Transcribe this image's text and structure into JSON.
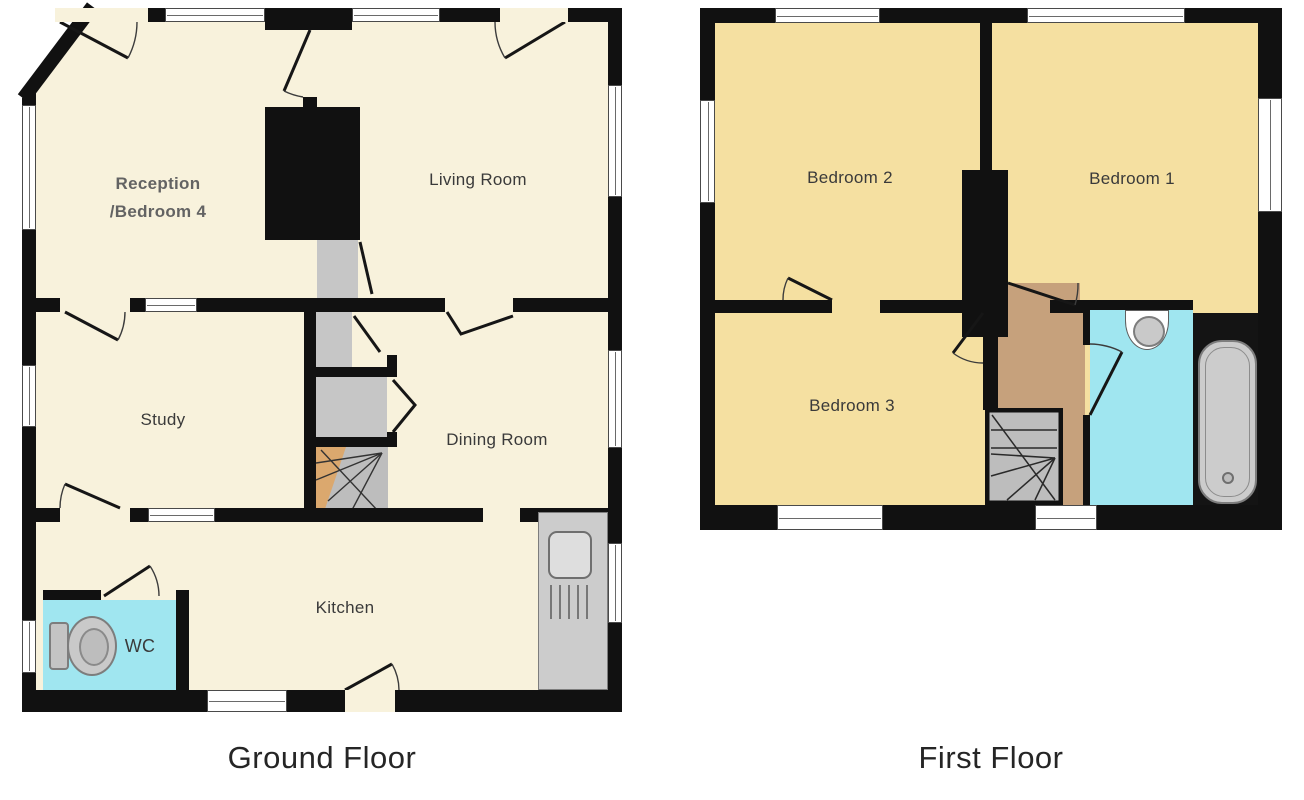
{
  "document_type": "property-floor-plan",
  "ground_floor": {
    "title": "Ground Floor",
    "rooms": {
      "reception_line1": "Reception",
      "reception_line2": "/Bedroom 4",
      "living_room": "Living Room",
      "study": "Study",
      "dining_room": "Dining Room",
      "kitchen": "Kitchen",
      "wc": "WC"
    }
  },
  "first_floor": {
    "title": "First Floor",
    "rooms": {
      "bedroom2": "Bedroom 2",
      "bedroom1": "Bedroom 1",
      "bedroom3": "Bedroom 3"
    }
  },
  "colors": {
    "wall": "#111111",
    "ground_room_fill": "#f8f2dc",
    "first_room_fill": "#f5e0a1",
    "wet_room_fill": "#a0e6f0",
    "landing_fill": "#c6a17c",
    "hall_fill": "#c6c6c6",
    "stair_tread_fill": "#bdbdbd"
  }
}
